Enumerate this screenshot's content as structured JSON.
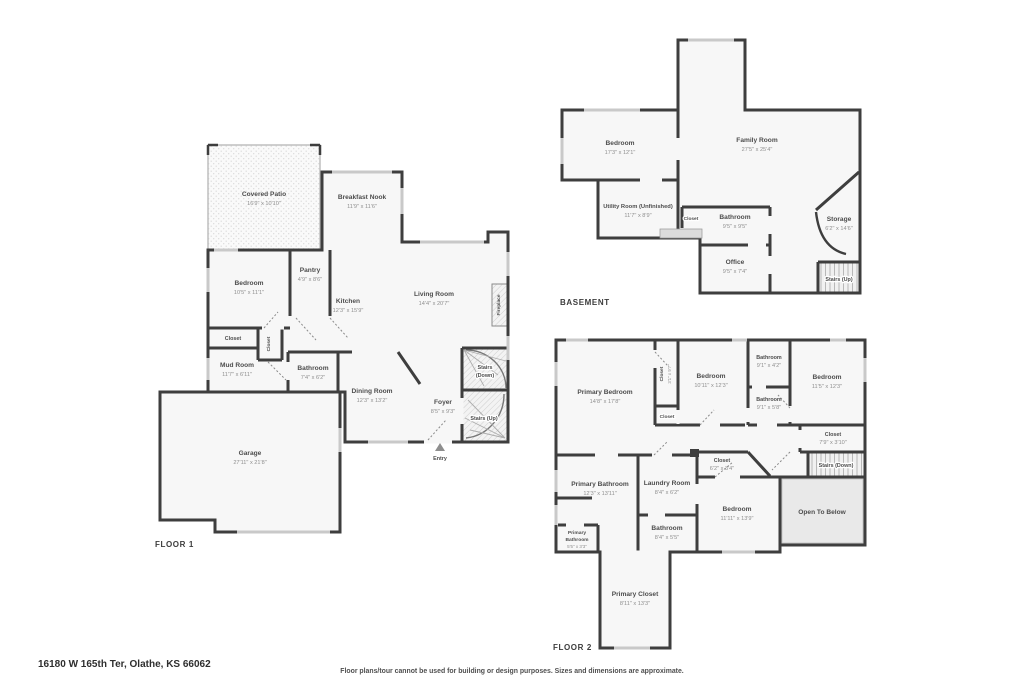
{
  "floor1": {
    "label": "FLOOR 1",
    "rooms": {
      "covered_patio": {
        "name": "Covered Patio",
        "dims": "16'9\" x 10'10\""
      },
      "breakfast_nook": {
        "name": "Breakfast Nook",
        "dims": "11'9\" x 11'6\""
      },
      "bedroom": {
        "name": "Bedroom",
        "dims": "10'5\" x 11'1\""
      },
      "pantry": {
        "name": "Pantry",
        "dims": "4'9\" x 8'6\""
      },
      "kitchen": {
        "name": "Kitchen",
        "dims": "12'3\" x 15'9\""
      },
      "living_room": {
        "name": "Living Room",
        "dims": "14'4\" x 20'7\""
      },
      "fireplace": {
        "name": "Fireplace"
      },
      "closet_a": {
        "name": "Closet"
      },
      "closet_b": {
        "name": "Closet"
      },
      "mud_room": {
        "name": "Mud Room",
        "dims": "11'7\" x 6'11\""
      },
      "bathroom": {
        "name": "Bathroom",
        "dims": "7'4\" x 6'2\""
      },
      "dining_room": {
        "name": "Dining Room",
        "dims": "12'3\" x 13'2\""
      },
      "foyer": {
        "name": "Foyer",
        "dims": "8'5\" x 9'3\""
      },
      "stairs_down": {
        "line1": "Stairs",
        "line2": "(Down)"
      },
      "stairs_up": {
        "name": "Stairs (Up)"
      },
      "garage": {
        "name": "Garage",
        "dims": "27'11\" x 21'8\""
      },
      "entry": {
        "name": "Entry"
      }
    }
  },
  "basement": {
    "label": "BASEMENT",
    "rooms": {
      "bedroom": {
        "name": "Bedroom",
        "dims": "17'3\" x 12'1\""
      },
      "family_room": {
        "name": "Family Room",
        "dims": "27'5\" x 25'4\""
      },
      "utility_room": {
        "name": "Utility Room (Unfinished)",
        "dims": "11'7\" x 8'9\""
      },
      "closet": {
        "name": "Closet"
      },
      "bathroom": {
        "name": "Bathroom",
        "dims": "9'5\" x 9'5\""
      },
      "office": {
        "name": "Office",
        "dims": "9'5\" x 7'4\""
      },
      "storage": {
        "name": "Storage",
        "dims": "6'2\" x 14'6\""
      },
      "stairs_up": {
        "name": "Stairs (Up)"
      }
    }
  },
  "floor2": {
    "label": "FLOOR 2",
    "rooms": {
      "primary_bedroom": {
        "name": "Primary Bedroom",
        "dims": "14'8\" x 17'8\""
      },
      "closet_tall": {
        "name": "Closet",
        "dims": "3'1\" x 9'7\""
      },
      "closet_small": {
        "name": "Closet"
      },
      "bedroom_mid": {
        "name": "Bedroom",
        "dims": "10'11\" x 12'3\""
      },
      "bathroom_top": {
        "name": "Bathroom",
        "dims": "9'1\" x 4'2\""
      },
      "bathroom_mid": {
        "name": "Bathroom",
        "dims": "9'1\" x 5'8\""
      },
      "bedroom_right": {
        "name": "Bedroom",
        "dims": "11'5\" x 12'3\""
      },
      "closet_right": {
        "name": "Closet",
        "dims": "7'9\" x 3'10\""
      },
      "stairs_down": {
        "name": "Stairs (Down)"
      },
      "open_to_below": {
        "name": "Open To Below"
      },
      "primary_bathroom": {
        "name": "Primary Bathroom",
        "dims": "12'3\" x 13'11\""
      },
      "laundry_room": {
        "name": "Laundry Room",
        "dims": "8'4\" x 6'2\""
      },
      "closet_mid": {
        "name": "Closet",
        "dims": "6'2\" x 3'4\""
      },
      "bedroom_bottom": {
        "name": "Bedroom",
        "dims": "11'11\" x 13'9\""
      },
      "primary_bathroom_small": {
        "line1": "Primary",
        "line2": "Bathroom",
        "dims": "5'5\" x 3'3\""
      },
      "bathroom_bottom": {
        "name": "Bathroom",
        "dims": "8'4\" x 5'5\""
      },
      "primary_closet": {
        "name": "Primary Closet",
        "dims": "8'11\" x 13'3\""
      }
    }
  },
  "footer": {
    "address": "16180 W 165th Ter, Olathe, KS 66062",
    "disclaimer": "Floor plans/tour cannot be used for building or design purposes. Sizes and dimensions are approximate."
  },
  "colors": {
    "wall": "#3e3e3e",
    "room_fill": "#f7f7f7",
    "window": "#c9c9c9",
    "text": "#4d4d4d"
  }
}
